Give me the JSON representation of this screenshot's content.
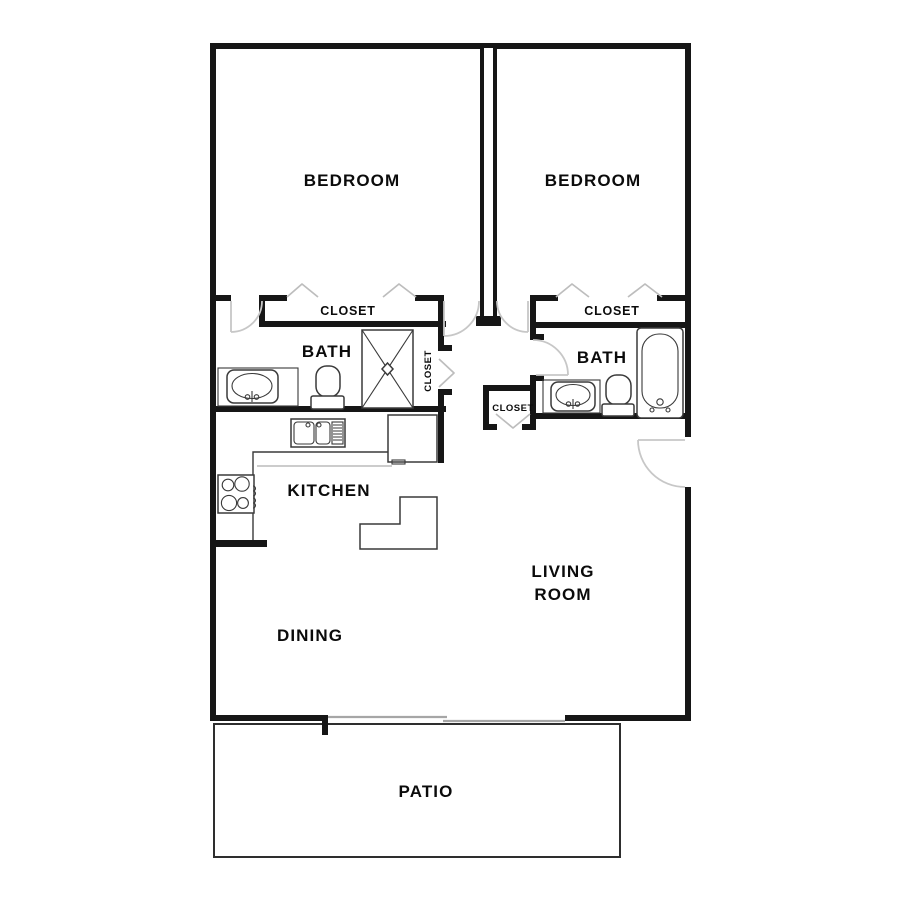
{
  "colors": {
    "background": "#ffffff",
    "wall": "#161616",
    "fixture": "#3a3a3a",
    "door": "#c7c7c7",
    "bifold": "#bdbdbd",
    "counter": "#bcbcbc",
    "sliding_door": "#a6a6a6",
    "patio_line": "#2e2e2e",
    "text": "#0b0b0b"
  },
  "floor_plan": {
    "rooms": {
      "bedroom_left": "BEDROOM",
      "bedroom_right": "BEDROOM",
      "bedroom_left_closet": "CLOSET",
      "bedroom_right_closet": "CLOSET",
      "bath_left": "BATH",
      "bath_right": "BATH",
      "hall_linen_closet": "CLOSET",
      "entry_closet": "CLOSET",
      "kitchen": "KITCHEN",
      "living_room_line1": "LIVING",
      "living_room_line2": "ROOM",
      "dining": "DINING",
      "patio": "PATIO"
    },
    "fixtures": [
      "shower",
      "vanity-sink-left",
      "toilet-left",
      "bathtub",
      "vanity-sink-right",
      "toilet-right",
      "kitchen-sink",
      "range",
      "refrigerator",
      "kitchen-island"
    ],
    "doors": [
      "bath-left-door",
      "bedroom-left-hall-door",
      "bedroom-right-hall-door",
      "bath-right-door",
      "entry-door",
      "sliding-glass-door",
      "bifold-closet-doors"
    ]
  }
}
